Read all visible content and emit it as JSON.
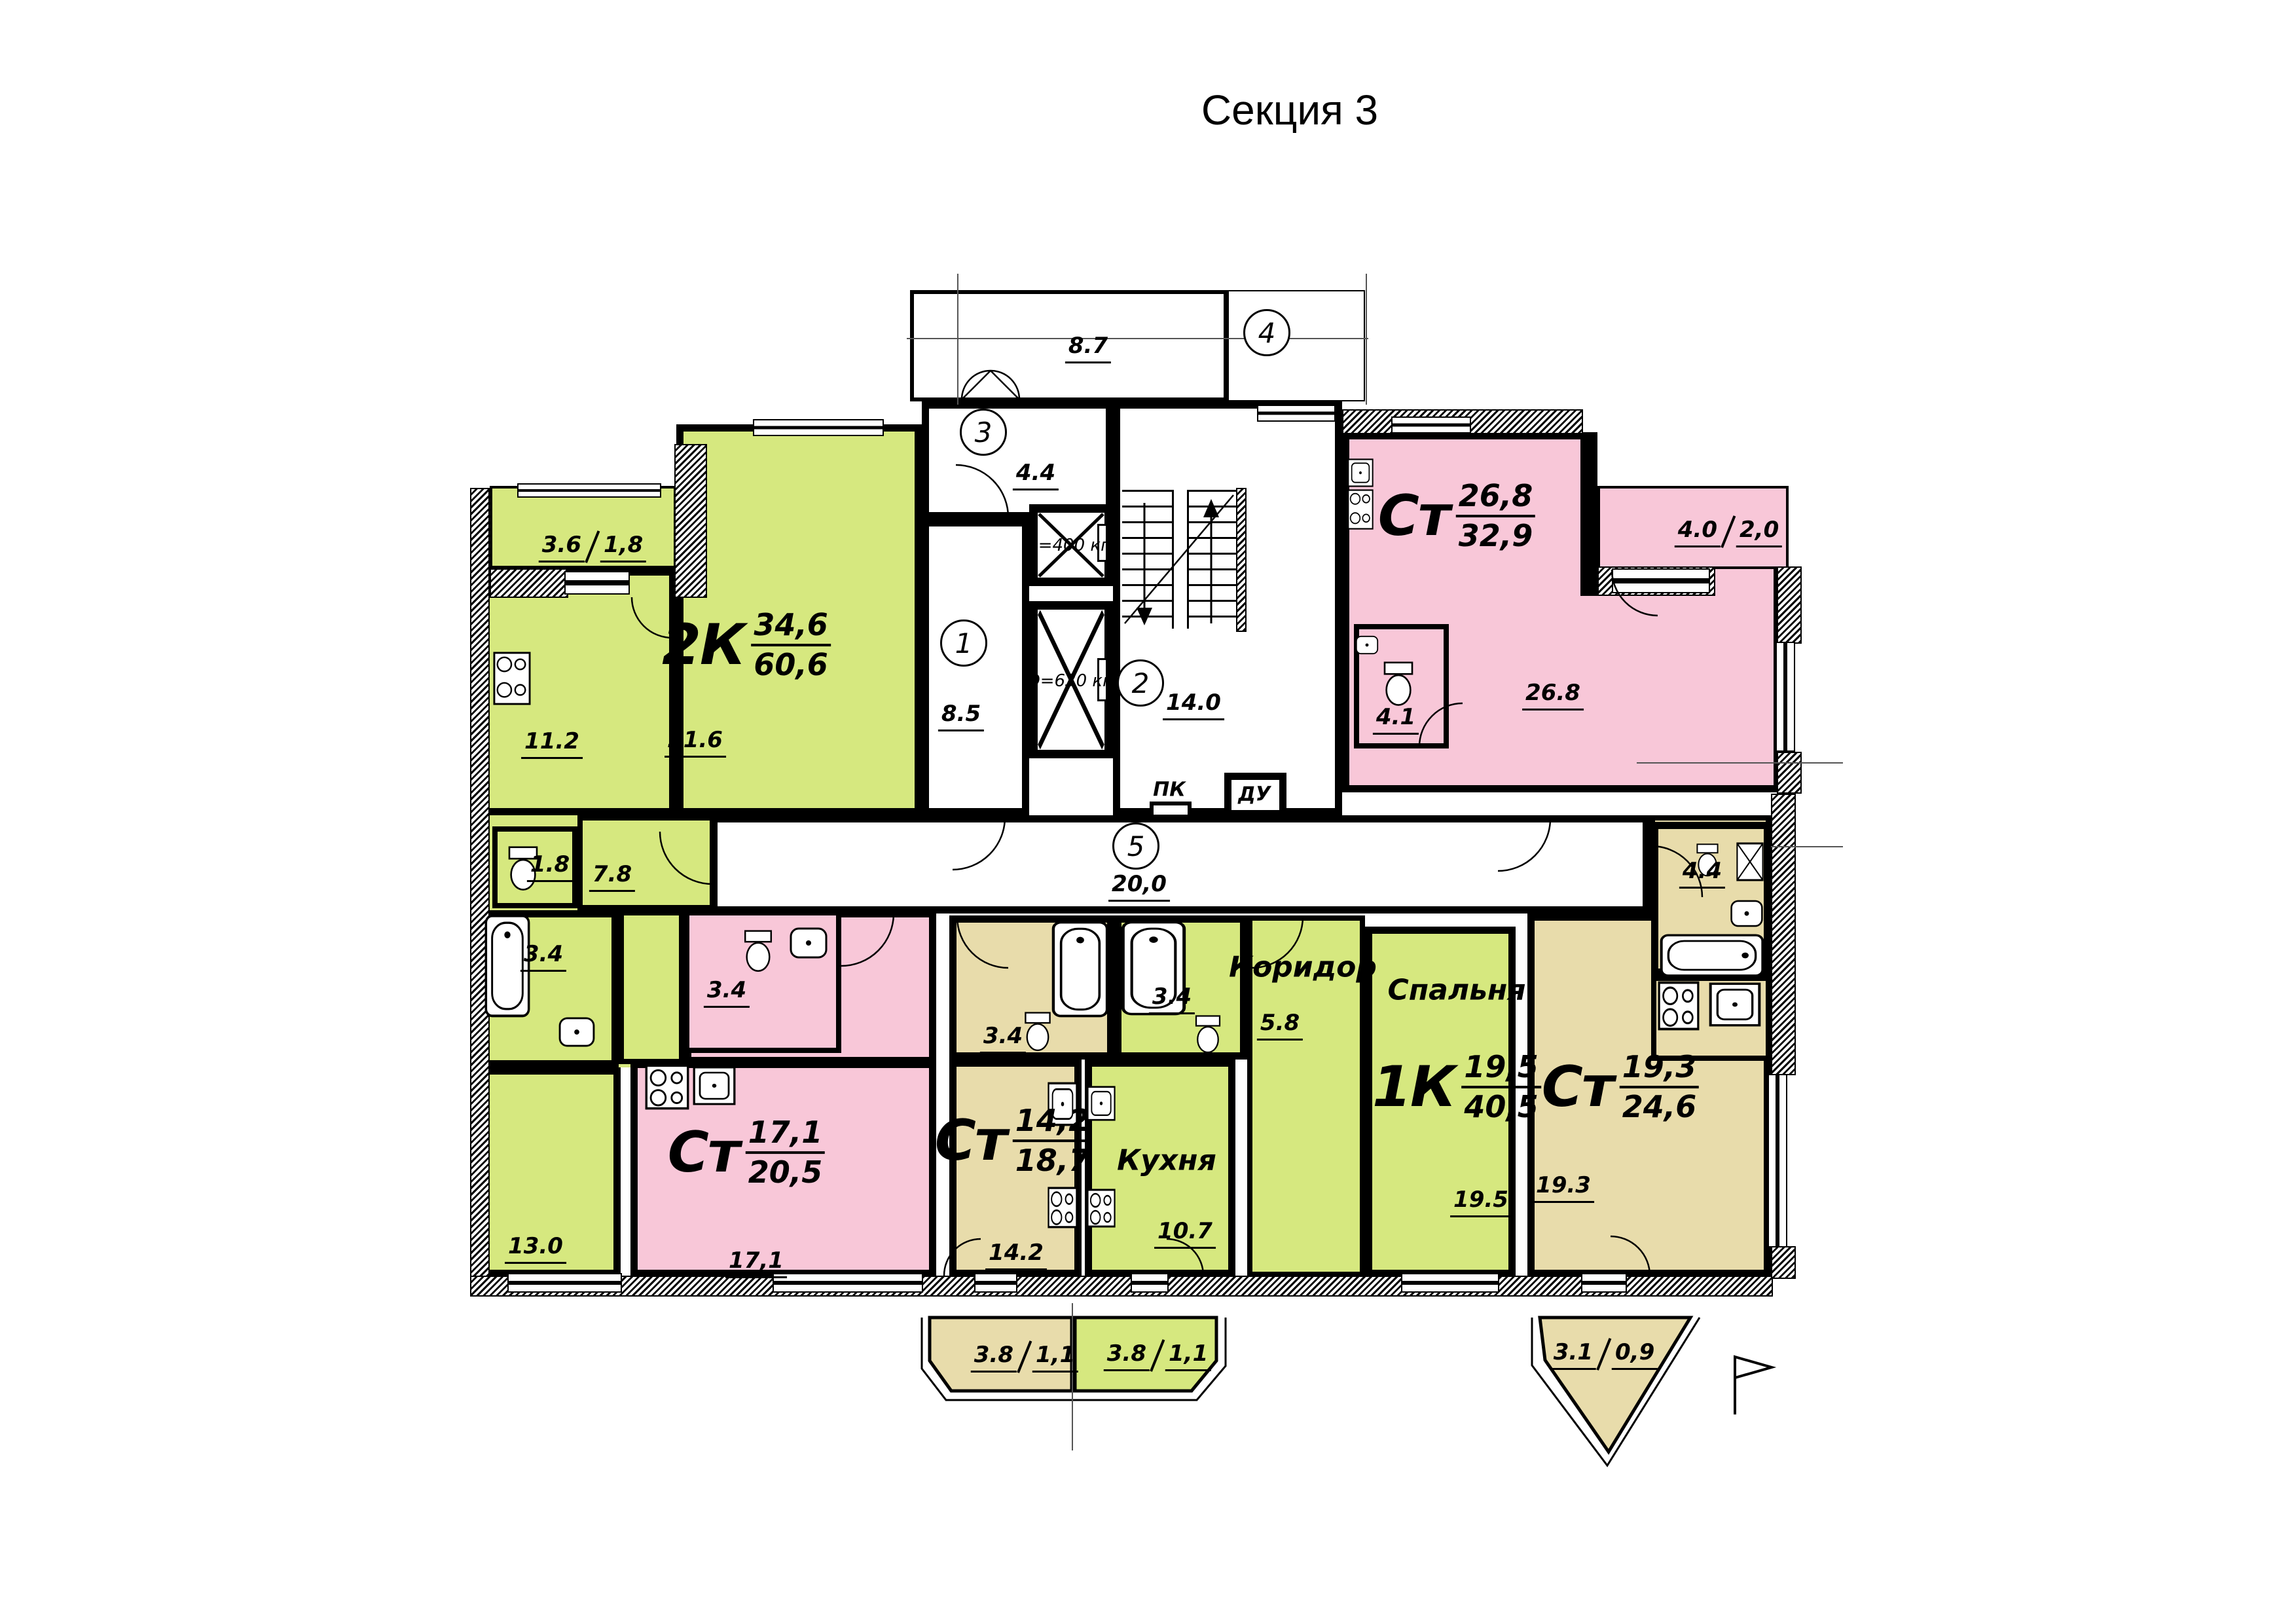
{
  "title": "Секция 3",
  "colors": {
    "green": "#d6e87f",
    "pink": "#f8c7d8",
    "beige": "#e8dcab"
  },
  "core": {
    "porch": "8.7",
    "vestibule": "4.4",
    "lobby": "8.5",
    "stairs": "14.0",
    "corridor": "20,0",
    "elevator_small": "Q=400 кг",
    "elevator_large": "Q=630 кг",
    "fire_cabinet": "ПК",
    "smoke_exhaust": "ДУ",
    "pos1": "1",
    "pos2": "2",
    "pos3": "3",
    "pos4": "4",
    "pos5": "5"
  },
  "apartments": {
    "a2k": {
      "type": "2К",
      "area_living": "34,6",
      "area_total": "60,6",
      "living": "21.6",
      "kitchen": "11.2",
      "room": "13.0",
      "hall": "7.8",
      "wc": "1.8",
      "bath": "3.4",
      "balcony_a": "3.6",
      "balcony_b": "1,8"
    },
    "st26": {
      "type": "Ст",
      "area_living": "26,8",
      "area_total": "32,9",
      "main": "26.8",
      "bath": "4.1",
      "balcony_a": "4.0",
      "balcony_b": "2,0"
    },
    "st17": {
      "type": "Ст",
      "area_living": "17,1",
      "area_total": "20,5",
      "main": "17,1",
      "bath": "3.4"
    },
    "st14": {
      "type": "Ст",
      "area_living": "14,2",
      "area_total": "18,7",
      "main": "14.2",
      "bath": "3.4",
      "balcony_a": "3.8",
      "balcony_b": "1,1"
    },
    "a1k": {
      "type": "1К",
      "area_living": "19,5",
      "area_total": "40,5",
      "bedroom_name": "Спальня",
      "bedroom": "19.5",
      "kitchen_name": "Кухня",
      "kitchen": "10.7",
      "corridor_name": "Коридор",
      "corridor": "5.8",
      "bath": "3.4",
      "balcony_a": "3.8",
      "balcony_b": "1,1"
    },
    "st19": {
      "type": "Ст",
      "area_living": "19,3",
      "area_total": "24,6",
      "main": "19.3",
      "bath": "4.4",
      "balcony_a": "3.1",
      "balcony_b": "0,9"
    }
  }
}
